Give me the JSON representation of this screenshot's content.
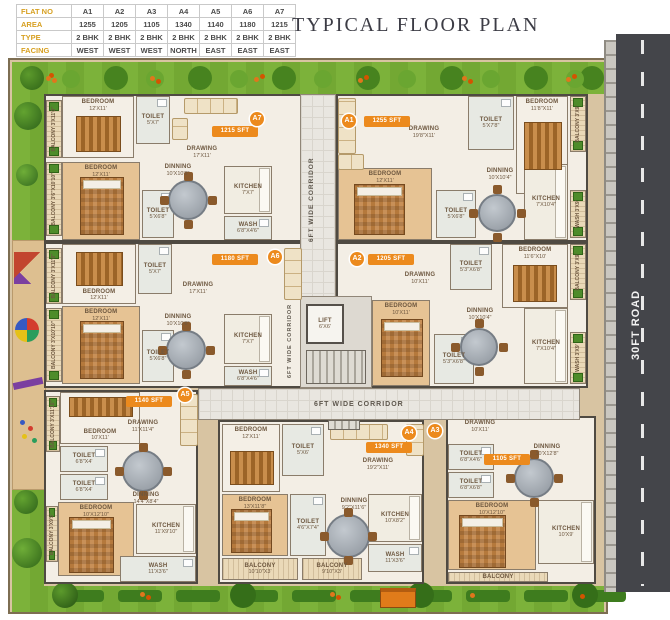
{
  "title": "TYPICAL FLOOR PLAN",
  "road_label": "30FT ROAD",
  "corridors": {
    "vertical": "6FT WIDE CORRIDOR",
    "horizontal": "6FT WIDE CORRIDOR"
  },
  "core": {
    "lift_name": "LIFT",
    "lift_dims": "6'X6'"
  },
  "flat_table": {
    "row_labels": [
      "FLAT NO",
      "AREA",
      "TYPE",
      "FACING"
    ],
    "flats": [
      {
        "no": "A1",
        "area": "1255",
        "type": "2 BHK",
        "facing": "WEST"
      },
      {
        "no": "A2",
        "area": "1205",
        "type": "2 BHK",
        "facing": "WEST"
      },
      {
        "no": "A3",
        "area": "1105",
        "type": "2 BHK",
        "facing": "WEST"
      },
      {
        "no": "A4",
        "area": "1340",
        "type": "2 BHK",
        "facing": "NORTH"
      },
      {
        "no": "A5",
        "area": "1140",
        "type": "2 BHK",
        "facing": "EAST"
      },
      {
        "no": "A6",
        "area": "1180",
        "type": "2 BHK",
        "facing": "EAST"
      },
      {
        "no": "A7",
        "area": "1215",
        "type": "2 BHK",
        "facing": "EAST"
      }
    ]
  },
  "units": {
    "a7": {
      "id": "A7",
      "sft": "1215 SFT",
      "rooms": {
        "bedroom1": {
          "name": "BEDROOM",
          "dims": "12'X11'"
        },
        "toilet1": {
          "name": "TOILET",
          "dims": "5'X7'"
        },
        "drawing": {
          "name": "DRAWING",
          "dims": "17'X11'"
        },
        "bedroom2": {
          "name": "BEDROOM",
          "dims": "12'X11'"
        },
        "toilet2": {
          "name": "TOILET",
          "dims": "5'X6'8\""
        },
        "dinning": {
          "name": "DINNING",
          "dims": "10'X10'8\""
        },
        "kitchen": {
          "name": "KITCHEN",
          "dims": "7'X7'"
        },
        "wash": {
          "name": "WASH",
          "dims": "6'8\"X4'6\""
        },
        "balcony1": {
          "name": "BALCONY",
          "dims": "3'X11'0\""
        },
        "balcony2": {
          "name": "BALCONY",
          "dims": "3'6\"X10'10\""
        }
      }
    },
    "a1": {
      "id": "A1",
      "sft": "1255 SFT",
      "rooms": {
        "drawing": {
          "name": "DRAWING",
          "dims": "19'8\"X11'"
        },
        "toilet1": {
          "name": "TOILET",
          "dims": "5'X7'8\""
        },
        "bedroom1": {
          "name": "BEDROOM",
          "dims": "11'8\"X11'"
        },
        "balcony1": {
          "name": "BALCONY",
          "dims": "3'X9'"
        },
        "bedroom2": {
          "name": "BEDROOM",
          "dims": "12'X11'"
        },
        "toilet2": {
          "name": "TOILET",
          "dims": "5'X6'8\""
        },
        "dinning": {
          "name": "DINNING",
          "dims": "10'X10'4\""
        },
        "kitchen": {
          "name": "KITCHEN",
          "dims": "7'X10'4\""
        },
        "wash": {
          "name": "WASH",
          "dims": "3'X9'"
        }
      }
    },
    "a6": {
      "id": "A6",
      "sft": "1180 SFT",
      "rooms": {
        "bedroom1": {
          "name": "BEDROOM",
          "dims": "12'X11'"
        },
        "toilet1": {
          "name": "TOILET",
          "dims": "5'X7'"
        },
        "drawing": {
          "name": "DRAWING",
          "dims": "17'X11'"
        },
        "bedroom2": {
          "name": "BEDROOM",
          "dims": "12'X11'"
        },
        "toilet2": {
          "name": "TOILET",
          "dims": "5'X6'8\""
        },
        "dinning": {
          "name": "DINNING",
          "dims": "10'X10'8\""
        },
        "kitchen": {
          "name": "KITCHEN",
          "dims": "7'X7'"
        },
        "wash": {
          "name": "WASH",
          "dims": "6'8\"X4'6\""
        },
        "balcony1": {
          "name": "BALCONY",
          "dims": "3'X11'0\""
        },
        "balcony2": {
          "name": "BALCONY",
          "dims": "3'X10'10\""
        }
      }
    },
    "a2": {
      "id": "A2",
      "sft": "1205 SFT",
      "rooms": {
        "toilet1": {
          "name": "TOILET",
          "dims": "5'3\"X6'8\""
        },
        "bedroom1": {
          "name": "BEDROOM",
          "dims": "11'6\"X10'"
        },
        "balcony1": {
          "name": "BALCONY",
          "dims": "3'X9'"
        },
        "drawing": {
          "name": "DRAWING",
          "dims": "10'X11'"
        },
        "bedroom2": {
          "name": "BEDROOM",
          "dims": "10'X11'"
        },
        "toilet2": {
          "name": "TOILET",
          "dims": "5'3\"X6'8\""
        },
        "dinning": {
          "name": "DINNING",
          "dims": "10'X10'4\""
        },
        "kitchen": {
          "name": "KITCHEN",
          "dims": "7'X10'4\""
        },
        "wash": {
          "name": "WASH",
          "dims": "3'X9'"
        }
      }
    },
    "a5": {
      "id": "A5",
      "sft": "1140 SFT",
      "rooms": {
        "bedroom1": {
          "name": "BEDROOM",
          "dims": "10'X11'"
        },
        "balcony1": {
          "name": "BALCONY",
          "dims": "3'X11'10\""
        },
        "drawing": {
          "name": "DRAWING",
          "dims": "11'X11'4\""
        },
        "toilet1": {
          "name": "TOILET",
          "dims": "6'8\"X4'"
        },
        "toilet2": {
          "name": "TOILET",
          "dims": "6'8\"X4'"
        },
        "dinning": {
          "name": "DINNING",
          "dims": "14'4\"X8'4\""
        },
        "bedroom2": {
          "name": "BEDROOM",
          "dims": "10'X12'10\""
        },
        "balcony2": {
          "name": "BALCONY",
          "dims": "3'X9'5\""
        },
        "kitchen": {
          "name": "KITCHEN",
          "dims": "11'X9'10\""
        },
        "wash": {
          "name": "WASH",
          "dims": "11'X3'6\""
        }
      }
    },
    "a4": {
      "id": "A4",
      "sft": "1340 SFT",
      "rooms": {
        "bedroom1": {
          "name": "BEDROOM",
          "dims": "12'X11'"
        },
        "toilet1": {
          "name": "TOILET",
          "dims": "5'X6'"
        },
        "drawing": {
          "name": "DRAWING",
          "dims": "19'2\"X11'"
        },
        "bedroom2": {
          "name": "BEDROOM",
          "dims": "13'X11'8\""
        },
        "toilet2": {
          "name": "TOILET",
          "dims": "4'6\"X7'4\""
        },
        "dinning": {
          "name": "DINNING",
          "dims": "9'2\"X11'6\""
        },
        "kitchen": {
          "name": "KITCHEN",
          "dims": "10'X8'2\""
        },
        "wash": {
          "name": "WASH",
          "dims": "11'X3'6\""
        },
        "balcony1": {
          "name": "BALCONY",
          "dims": "10'10\"X3'"
        },
        "balcony2": {
          "name": "BALCONY",
          "dims": "9'10\"X3'"
        }
      }
    },
    "a3": {
      "id": "A3",
      "sft": "1105 SFT",
      "rooms": {
        "drawing": {
          "name": "DRAWING",
          "dims": "10'X11'"
        },
        "toilet1": {
          "name": "TOILET",
          "dims": "6'8\"X4'6\""
        },
        "toilet2": {
          "name": "TOILET",
          "dims": "6'8\"X6'8\""
        },
        "dinning": {
          "name": "DINNING",
          "dims": "10'X12'8\""
        },
        "bedroom1": {
          "name": "BEDROOM",
          "dims": "10'X12'10\""
        },
        "kitchen": {
          "name": "KITCHEN",
          "dims": "10'X9'"
        },
        "balcony1": {
          "name": "BALCONY",
          "dims": ""
        }
      }
    }
  }
}
